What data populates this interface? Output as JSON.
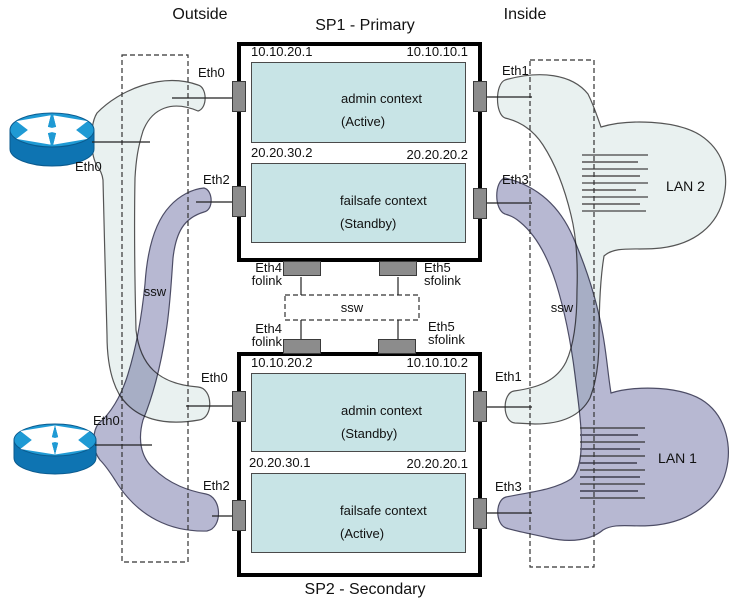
{
  "page": {
    "outside_label": "Outside",
    "inside_label": "Inside"
  },
  "sp1": {
    "title": "SP1 - Primary",
    "admin_context": {
      "label": "admin context",
      "state": "(Active)",
      "outside_ip": "10.10.20.1",
      "inside_ip": "10.10.10.1"
    },
    "failsafe_context": {
      "label": "failsafe context",
      "state": "(Standby)",
      "outside_ip": "20.20.30.2",
      "inside_ip": "20.20.20.2"
    },
    "ports": {
      "outside_admin": "Eth0",
      "outside_failsafe": "Eth2",
      "inside_admin": "Eth1",
      "inside_failsafe": "Eth3",
      "folink": {
        "port": "Eth4",
        "label": "folink"
      },
      "sfolink": {
        "port": "Eth5",
        "label": "sfolink"
      }
    }
  },
  "sp2": {
    "title": "SP2 - Secondary",
    "admin_context": {
      "label": "admin context",
      "state": "(Standby)",
      "outside_ip": "10.10.20.2",
      "inside_ip": "10.10.10.2"
    },
    "failsafe_context": {
      "label": "failsafe context",
      "state": "(Active)",
      "outside_ip": "20.20.30.1",
      "inside_ip": "20.20.20.1"
    },
    "ports": {
      "outside_admin": "Eth0",
      "outside_failsafe": "Eth2",
      "inside_admin": "Eth1",
      "inside_failsafe": "Eth3",
      "folink": {
        "port": "Eth4",
        "label": "folink"
      },
      "sfolink": {
        "port": "Eth5",
        "label": "sfolink"
      }
    }
  },
  "switches": {
    "outside": "ssw",
    "inside": "ssw",
    "failover": "ssw"
  },
  "routers": {
    "outside_top": {
      "port": "Eth0"
    },
    "outside_bottom": {
      "port": "Eth0"
    }
  },
  "lans": {
    "lan2": "LAN 2",
    "lan1": "LAN 1"
  },
  "colors": {
    "context_fill": "#c8e4e6",
    "segment_light": "#e9f1f0",
    "segment_purple": "#b7b8d2",
    "port_fill": "#8c8c8c",
    "router_top": "#1f9ad4",
    "router_side": "#0e74b2"
  }
}
